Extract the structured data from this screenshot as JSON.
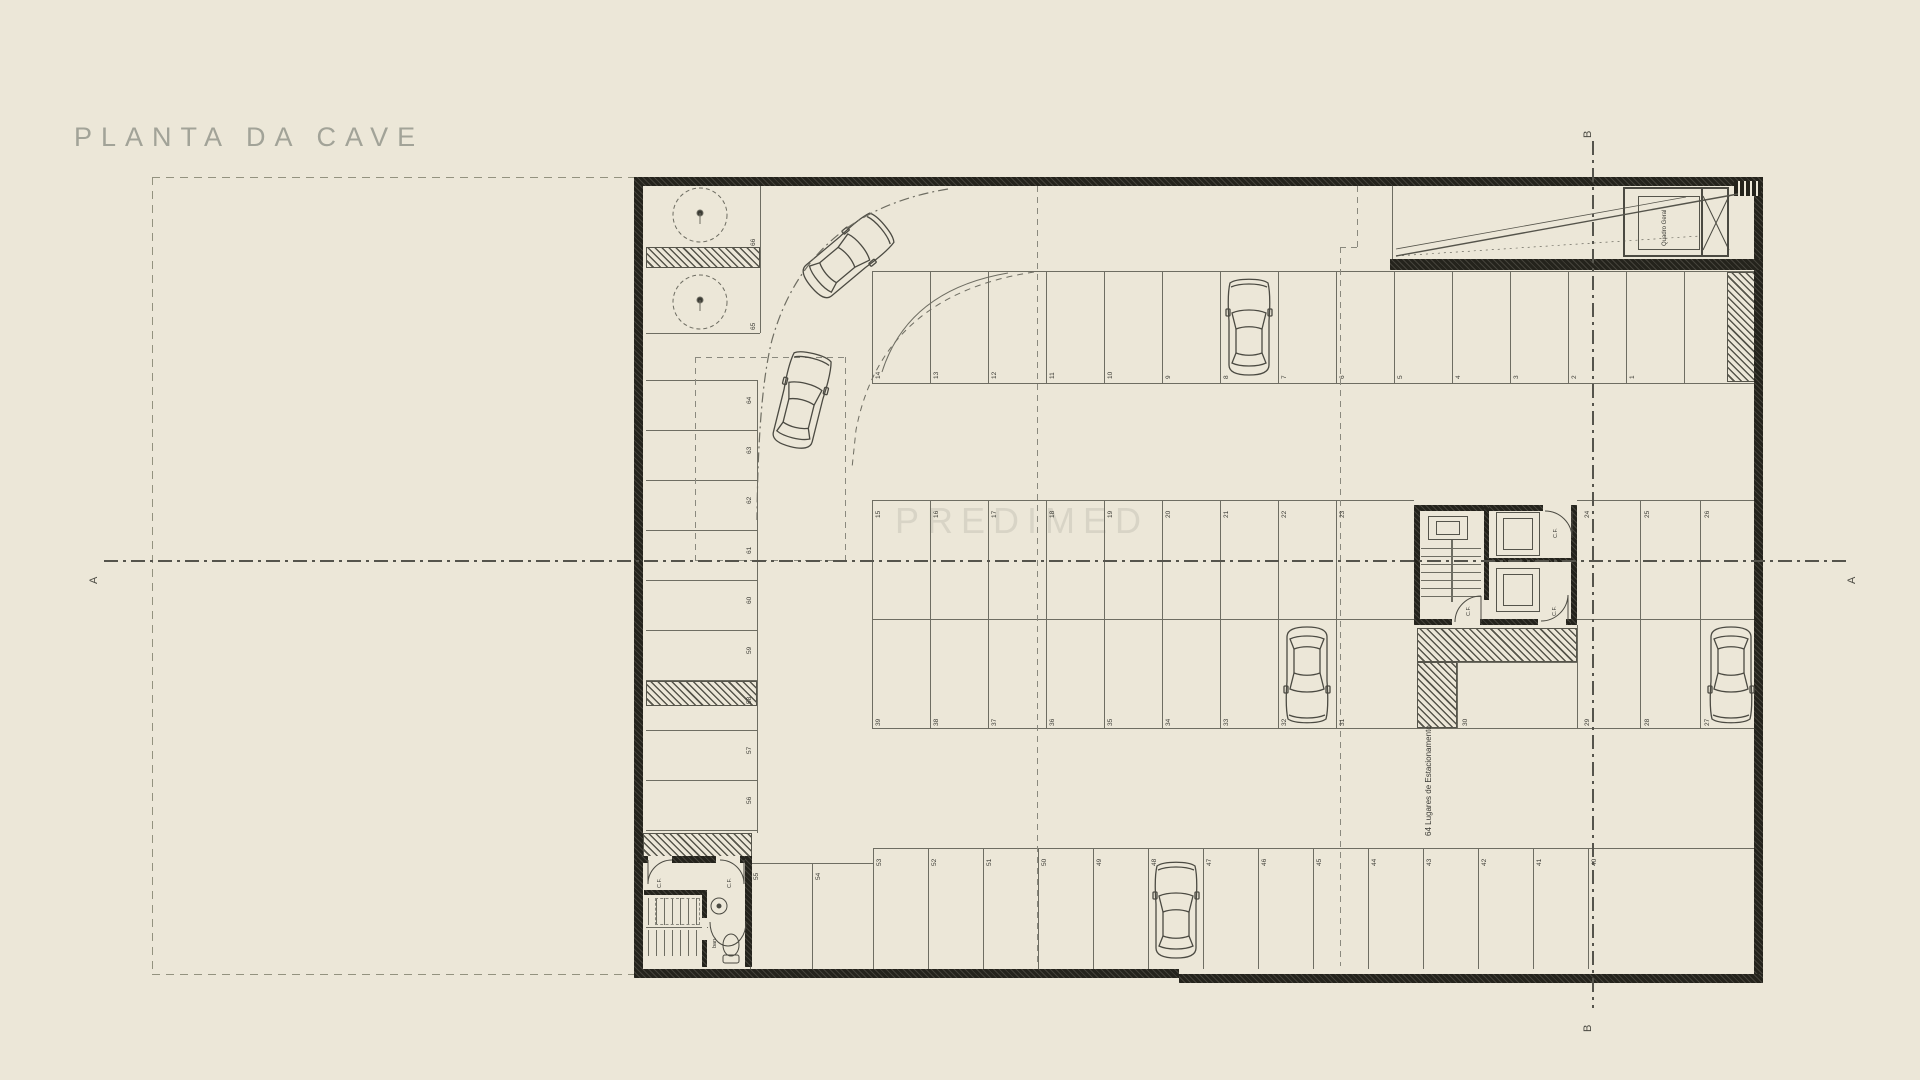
{
  "title": "PLANTA DA CAVE",
  "watermark": "PREDIMED",
  "sections": {
    "a_left": "A",
    "a_right": "A",
    "b_top": "B",
    "b_bottom": "B"
  },
  "notes": {
    "capacity": "64 Lugares de Estacionamento"
  },
  "rooms": {
    "bath": "ban.",
    "electrical": "Quadro Geral"
  },
  "doors": {
    "fire": "C.F."
  },
  "stalls": {
    "corner": [
      "66",
      "65"
    ],
    "left_column": [
      "64",
      "63",
      "62",
      "61",
      "60",
      "59",
      "58",
      "57",
      "56"
    ],
    "top_row": [
      "14",
      "13",
      "12",
      "11",
      "10",
      "9",
      "8",
      "7",
      "6",
      "5",
      "4",
      "3",
      "2",
      "1"
    ],
    "mid_top_left": [
      "15",
      "16",
      "17",
      "18",
      "19",
      "20",
      "21",
      "22",
      "23"
    ],
    "mid_top_right": [
      "24",
      "25",
      "26"
    ],
    "mid_bottom_left": [
      "39",
      "38",
      "37",
      "36",
      "35",
      "34",
      "33",
      "32",
      "31"
    ],
    "mid_bottom_right": [
      "30",
      "29",
      "28",
      "27"
    ],
    "bottom_step": [
      "55",
      "54"
    ],
    "bottom_row": [
      "53",
      "52",
      "51",
      "50",
      "49",
      "48",
      "47",
      "46",
      "45",
      "44",
      "43",
      "42",
      "41",
      "40"
    ]
  },
  "colors": {
    "background": "#ECE7D8",
    "line": "#6E6D62",
    "ink": "#4B4A42",
    "wall": "#24231C",
    "title_gray": "#A2A398",
    "dashed": "#8A897E"
  }
}
